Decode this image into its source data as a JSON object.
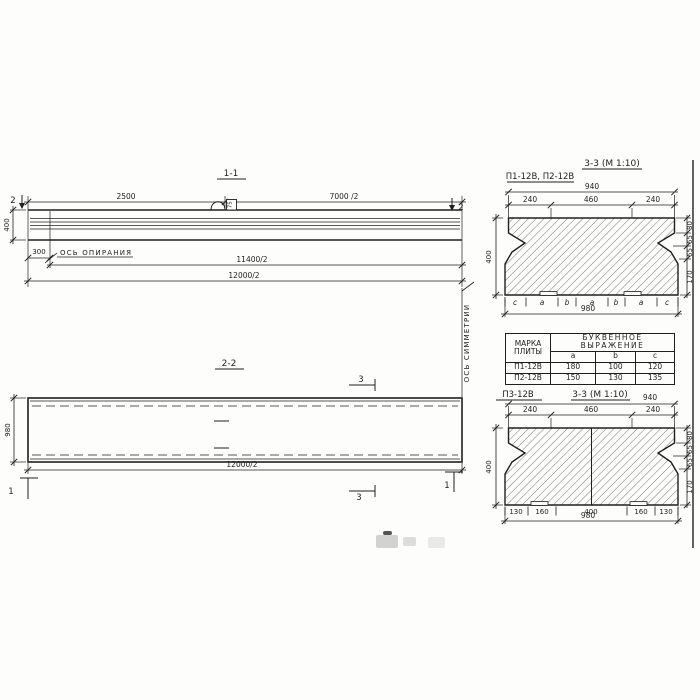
{
  "colors": {
    "ink": "#1f1f1f",
    "paper": "#fdfdfc"
  },
  "drawing": {
    "section11": {
      "title": "1-1",
      "cut_mark": "2",
      "dim_top_left": "2500",
      "dim_top_right": "7000 /2",
      "dim_height": "400",
      "dim_300": "300",
      "bearing_label": "ОСЬ ОПИРАНИЯ",
      "dim_11400": "11400/2",
      "dim_12000": "12000/2",
      "loop_label": "75"
    },
    "section22": {
      "title": "2-2",
      "mark3": "3",
      "mark1": "1",
      "dim_height": "980",
      "dim_12000": "12000/2",
      "symmetry_label": "ОСЬ СИММЕТРИИ"
    },
    "cross_top": {
      "label": "П1-12В, П2-12В",
      "title": "3-3 (М 1:10)",
      "dim_940": "940",
      "dims_top": [
        "240",
        "460",
        "240"
      ],
      "dim_400": "400",
      "dims_right": [
        "80",
        "65",
        "65",
        "170"
      ],
      "letters": [
        "c",
        "a",
        "b",
        "a",
        "b",
        "a",
        "c"
      ],
      "dim_980": "980"
    },
    "cross_bottom": {
      "label": "П3-12В",
      "title": "3-3 (М 1:10)",
      "dim_940": "940",
      "dims_top": [
        "240",
        "460",
        "240"
      ],
      "dim_400": "400",
      "dims_right": [
        "80",
        "65",
        "65",
        "170"
      ],
      "dims_bottom": [
        "130",
        "160",
        "400",
        "160",
        "130"
      ],
      "dim_980": "980"
    },
    "table": {
      "col1_header": "МАРКА ПЛИТЫ",
      "col2_header": "БУКВЕННОЕ ВЫРАЖЕНИЕ",
      "sub_headers": [
        "a",
        "b",
        "c"
      ],
      "rows": [
        {
          "mark": "П1-12В",
          "a": "180",
          "b": "100",
          "c": "120"
        },
        {
          "mark": "П2-12В",
          "a": "150",
          "b": "130",
          "c": "135"
        }
      ]
    }
  }
}
